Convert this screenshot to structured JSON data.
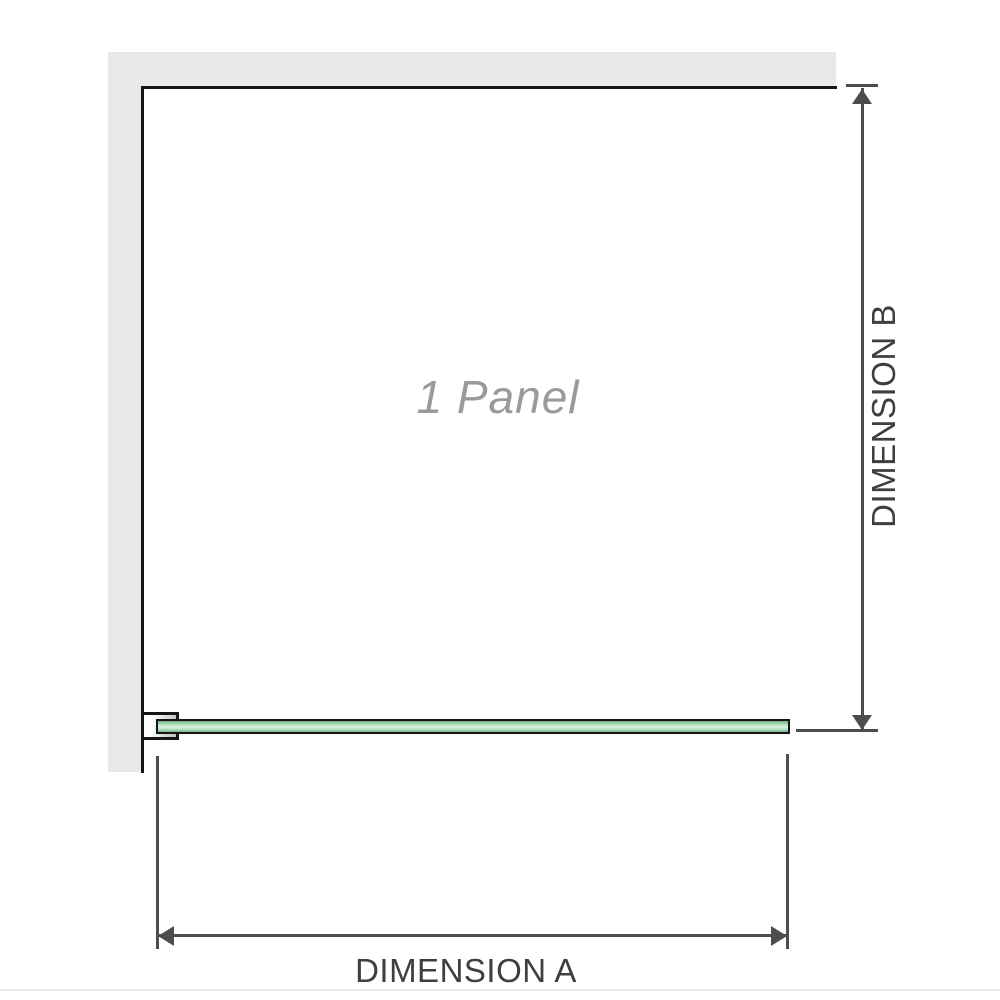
{
  "diagram": {
    "panel_label": "1 Panel",
    "dimension_a_label": "DIMENSION A",
    "dimension_b_label": "DIMENSION B"
  },
  "colors": {
    "wall_fill": "#e9e9e9",
    "outline": "#161616",
    "dim_line": "#4d4d4d",
    "dim_text": "#3f3f3f",
    "panel_label_gray": "#9a9a9a",
    "glass_green": "#a9dcb8",
    "glass_green_light": "#ddf2e2",
    "glass_green_dark": "#74b189",
    "bracket_gray": "#c6c6c6",
    "bottom_rule": "#eae8e2"
  }
}
